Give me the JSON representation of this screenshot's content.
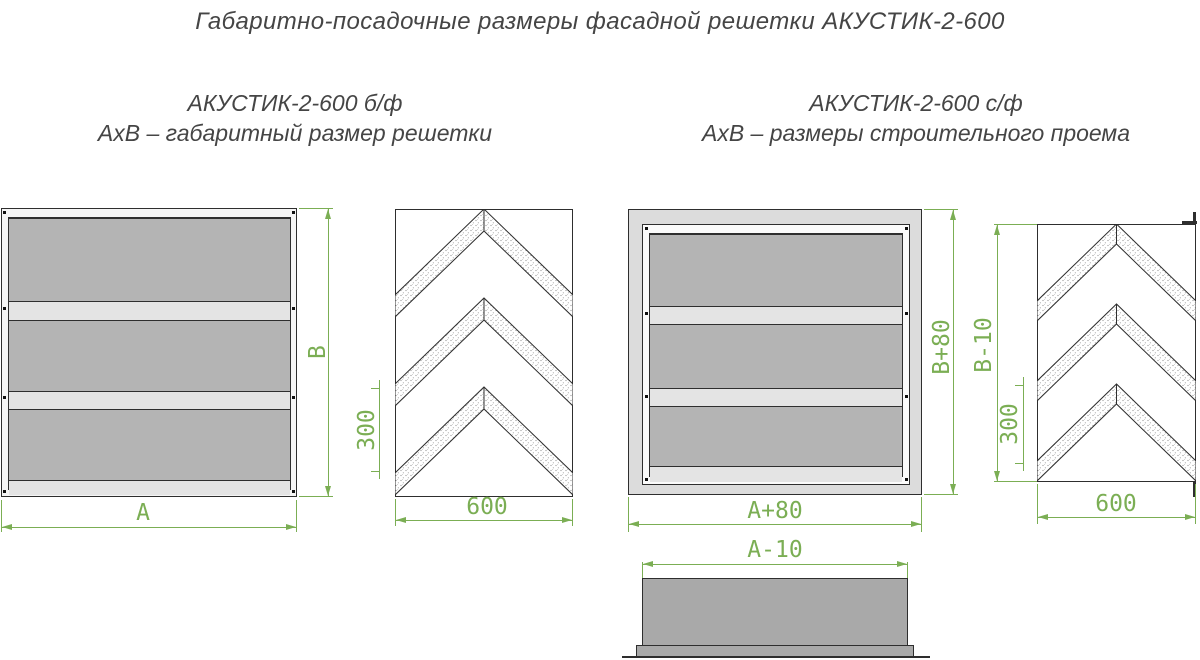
{
  "title": "Габаритно-посадочные размеры фасадной решетки АКУСТИК-2-600",
  "sections": {
    "left": {
      "heading": "АКУСТИК-2-600 б/ф",
      "subheading": "АхВ – габаритный размер решетки"
    },
    "right": {
      "heading": "АКУСТИК-2-600 с/ф",
      "subheading": "АхВ – размеры строительного проема"
    }
  },
  "dims": {
    "left_front": {
      "width": "А",
      "height": "В"
    },
    "left_side": {
      "width": "600",
      "pitch": "300"
    },
    "right_front": {
      "width": "А+80",
      "height": "В+80"
    },
    "right_side": {
      "width": "600",
      "pitch": "300",
      "opening_height": "В-10"
    },
    "bottom_view": {
      "width": "А-10"
    }
  },
  "colors": {
    "dimension": "#7bae54",
    "ink": "#2e2e2e",
    "text": "#454545",
    "panelDark": "#b4b4b4",
    "panelLight": "#e4e4e4",
    "flange": "#dcdcdc",
    "frameFill": "#f5f5f5",
    "bodyFill": "#a9a9a9"
  }
}
